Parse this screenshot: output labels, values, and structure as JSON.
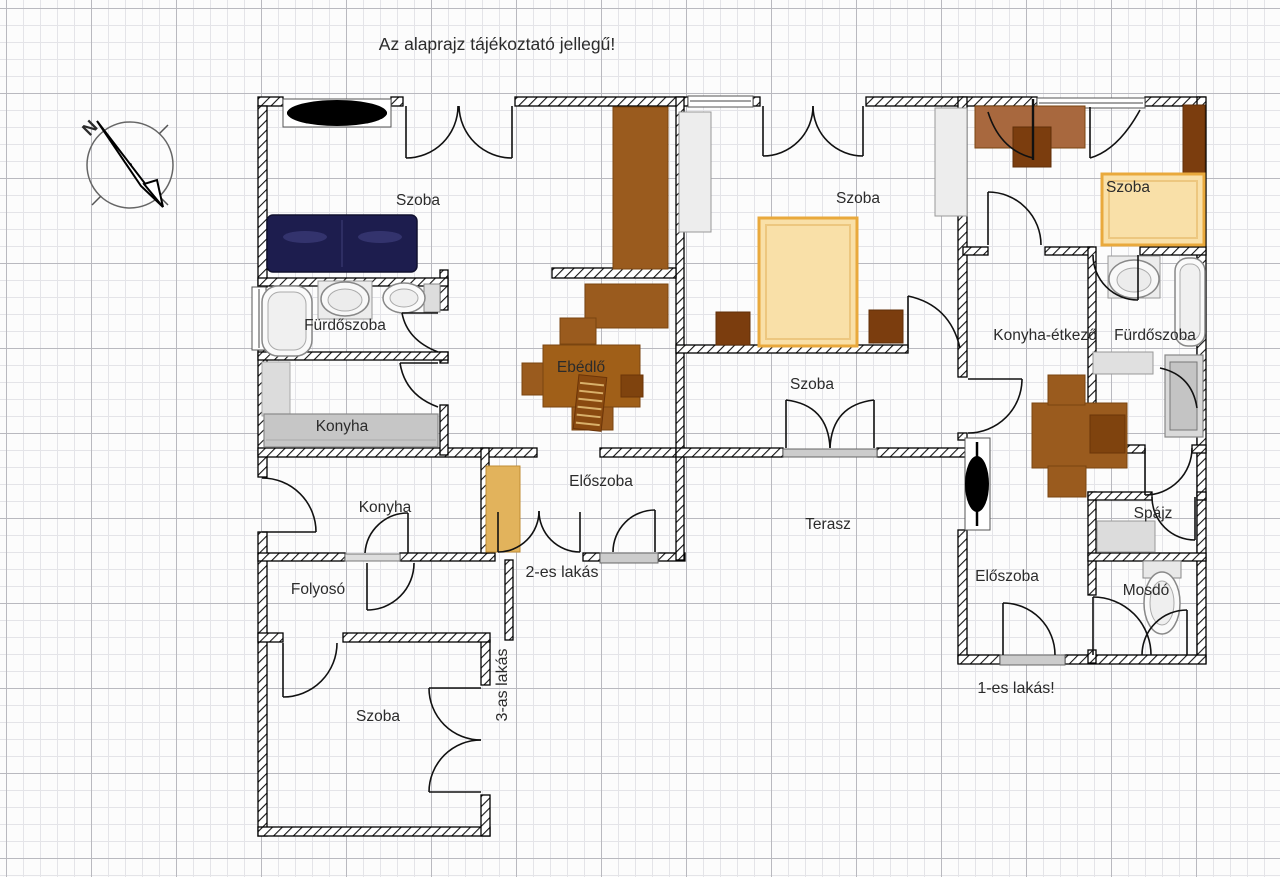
{
  "title": "Az alaprajz tájékoztató jellegű!",
  "compass": {
    "north_label": "N"
  },
  "apartments": {
    "apartment_1_label": "1-es lakás!",
    "apartment_2_label": "2-es lakás",
    "apartment_3_label": "3-as lakás"
  },
  "room_labels": {
    "szoba_top_left": "Szoba",
    "furdoszoba_left": "Fürdőszoba",
    "konyha_upper": "Konyha",
    "ebedlo": "Ebédlő",
    "szoba_middle": "Szoba",
    "szoba_center": "Szoba",
    "eloszoba_2": "Előszoba",
    "konyha_lower": "Konyha",
    "folyoso": "Folyosó",
    "szoba_bottom_left": "Szoba",
    "terasz": "Terasz",
    "szoba_top_right": "Szoba",
    "konyha_etkezo": "Konyha-étkező",
    "furdoszoba_right": "Fürdőszoba",
    "spajz": "Spájz",
    "mosdo": "Mosdó",
    "eloszoba_1": "Előszoba"
  },
  "colors": {
    "wall": "#000000",
    "furniture_brown": "#9a5b1e",
    "furniture_dark_brown": "#7b3d0e",
    "sofa_brown": "#a8683e",
    "bed_fill": "#f9e0a8",
    "bed_border": "#e9a93c",
    "wardrobe_tan": "#e2b35c",
    "sofa_navy": "#1d1d4e",
    "counter_gray": "#c6c6c6",
    "fixture_gray": "#e0e0e0",
    "grid_minor": "#e4e4e8",
    "grid_major": "#b9b9bf"
  }
}
